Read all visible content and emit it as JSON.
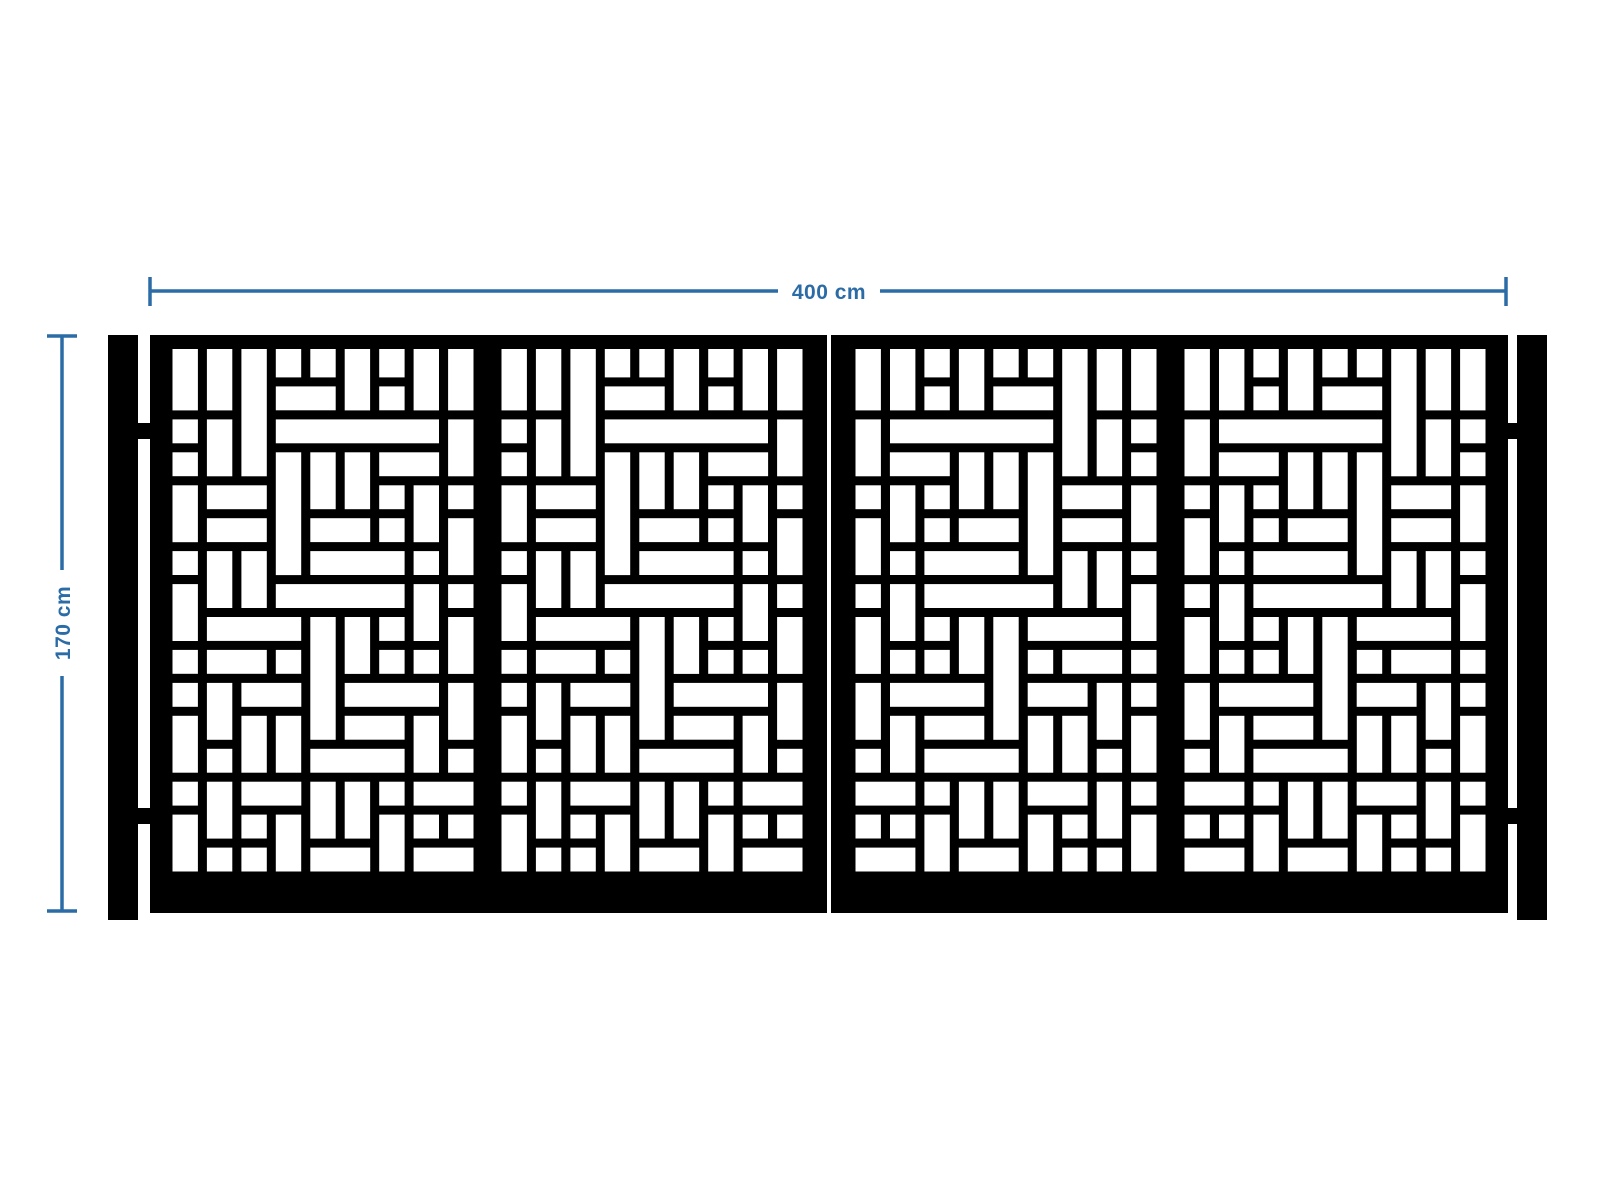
{
  "drawing": {
    "type": "gate-technical-drawing",
    "colors": {
      "background": "#ffffff",
      "gate": "#000000",
      "opening": "#ffffff",
      "dimension": "#2b6ca6"
    },
    "dimensions": {
      "width_label": "400 cm",
      "height_label": "170 cm"
    },
    "gate": {
      "post_count": 2,
      "leaf_count": 2,
      "panels_per_leaf": 2,
      "hinges_per_side": 2,
      "pattern_style": "rectangular basketweave laser-cut",
      "right_leaf_mirrored": true
    },
    "pattern": {
      "tile_cols": 9,
      "tile_rows": 16,
      "rects": [
        [
          0,
          0,
          1,
          2
        ],
        [
          1,
          0,
          1,
          2
        ],
        [
          2,
          0,
          1,
          4
        ],
        [
          3,
          0,
          1,
          1
        ],
        [
          4,
          0,
          1,
          1
        ],
        [
          5,
          0,
          1,
          2
        ],
        [
          6,
          0,
          1,
          1
        ],
        [
          7,
          0,
          1,
          2
        ],
        [
          8,
          0,
          1,
          2
        ],
        [
          3,
          1,
          2,
          1
        ],
        [
          6,
          1,
          1,
          1
        ],
        [
          0,
          2,
          1,
          1
        ],
        [
          1,
          2,
          1,
          2
        ],
        [
          3,
          2,
          5,
          1
        ],
        [
          8,
          2,
          1,
          2
        ],
        [
          0,
          3,
          1,
          1
        ],
        [
          3,
          3,
          1,
          4
        ],
        [
          4,
          3,
          1,
          2
        ],
        [
          5,
          3,
          1,
          2
        ],
        [
          6,
          3,
          2,
          1
        ],
        [
          0,
          4,
          1,
          2
        ],
        [
          1,
          4,
          2,
          1
        ],
        [
          6,
          4,
          1,
          1
        ],
        [
          7,
          4,
          1,
          2
        ],
        [
          8,
          4,
          1,
          1
        ],
        [
          1,
          5,
          2,
          1
        ],
        [
          4,
          5,
          2,
          1
        ],
        [
          6,
          5,
          1,
          1
        ],
        [
          8,
          5,
          1,
          2
        ],
        [
          0,
          6,
          1,
          1
        ],
        [
          1,
          6,
          1,
          2
        ],
        [
          2,
          6,
          1,
          2
        ],
        [
          4,
          6,
          3,
          1
        ],
        [
          7,
          6,
          1,
          1
        ],
        [
          0,
          7,
          1,
          2
        ],
        [
          3,
          7,
          4,
          1
        ],
        [
          7,
          7,
          1,
          2
        ],
        [
          8,
          7,
          1,
          1
        ],
        [
          1,
          8,
          3,
          1
        ],
        [
          4,
          8,
          1,
          4
        ],
        [
          5,
          8,
          1,
          2
        ],
        [
          6,
          8,
          1,
          1
        ],
        [
          8,
          8,
          1,
          2
        ],
        [
          0,
          9,
          1,
          1
        ],
        [
          1,
          9,
          2,
          1
        ],
        [
          3,
          9,
          1,
          1
        ],
        [
          6,
          9,
          1,
          1
        ],
        [
          7,
          9,
          1,
          1
        ],
        [
          0,
          10,
          1,
          1
        ],
        [
          1,
          10,
          1,
          2
        ],
        [
          2,
          10,
          2,
          1
        ],
        [
          5,
          10,
          3,
          1
        ],
        [
          8,
          10,
          1,
          2
        ],
        [
          0,
          11,
          1,
          2
        ],
        [
          2,
          11,
          1,
          2
        ],
        [
          3,
          11,
          1,
          2
        ],
        [
          5,
          11,
          2,
          1
        ],
        [
          7,
          11,
          1,
          2
        ],
        [
          1,
          12,
          1,
          1
        ],
        [
          4,
          12,
          3,
          1
        ],
        [
          8,
          12,
          1,
          1
        ],
        [
          0,
          13,
          1,
          1
        ],
        [
          1,
          13,
          1,
          2
        ],
        [
          2,
          13,
          2,
          1
        ],
        [
          4,
          13,
          1,
          2
        ],
        [
          5,
          13,
          1,
          2
        ],
        [
          6,
          13,
          1,
          1
        ],
        [
          7,
          13,
          2,
          1
        ],
        [
          0,
          14,
          1,
          2
        ],
        [
          2,
          14,
          1,
          1
        ],
        [
          3,
          14,
          1,
          2
        ],
        [
          6,
          14,
          1,
          2
        ],
        [
          7,
          14,
          1,
          1
        ],
        [
          8,
          14,
          1,
          1
        ],
        [
          1,
          15,
          1,
          1
        ],
        [
          2,
          15,
          1,
          1
        ],
        [
          4,
          15,
          2,
          1
        ],
        [
          7,
          15,
          2,
          1
        ]
      ]
    }
  }
}
